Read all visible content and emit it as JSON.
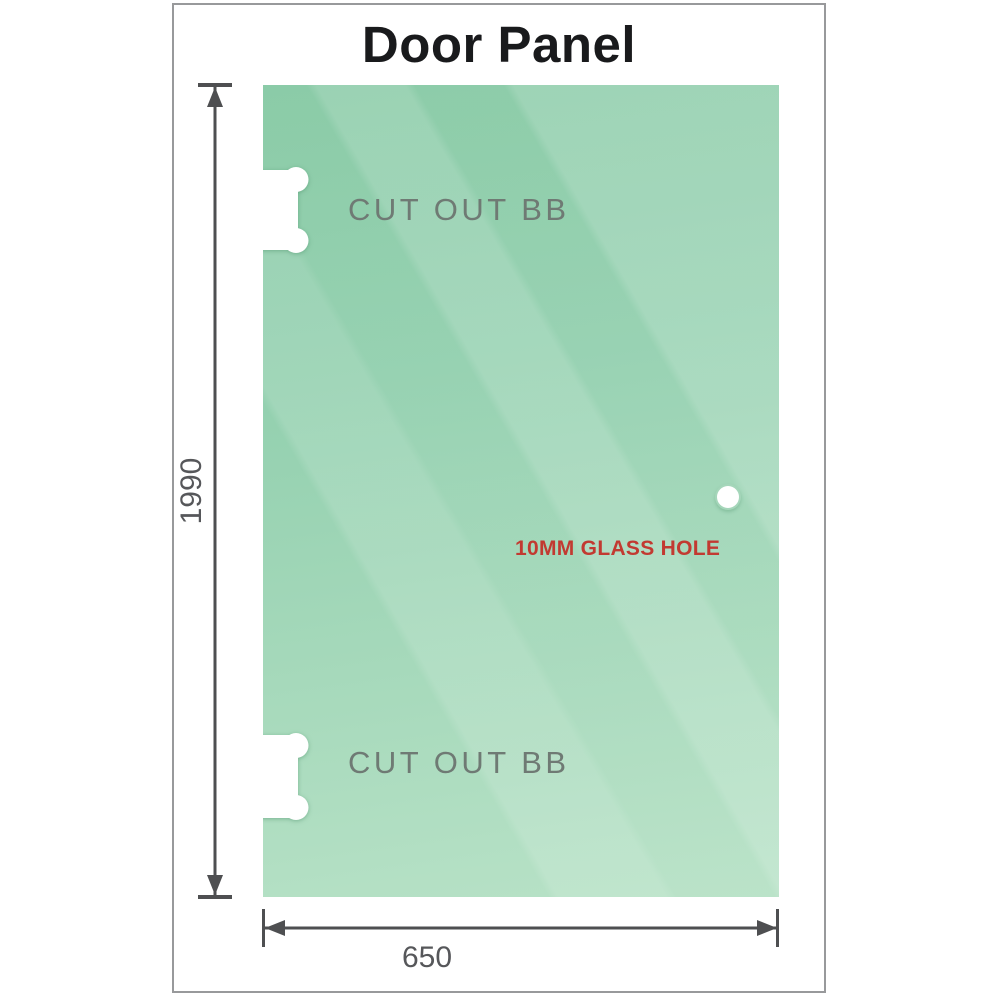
{
  "page": {
    "title": "Door Panel"
  },
  "panel": {
    "cutouts": [
      {
        "label": "CUT OUT BB",
        "position": "top-left"
      },
      {
        "label": "CUT OUT BB",
        "position": "bottom-left"
      }
    ],
    "hole": {
      "label": "10MM GLASS HOLE"
    }
  },
  "dimensions": {
    "height": {
      "value": "1990",
      "orientation": "vertical"
    },
    "width": {
      "value": "650",
      "orientation": "horizontal"
    }
  },
  "colors": {
    "frame_border": "#98999b",
    "title_text": "#191a1c",
    "glass_top": "#86c9a4",
    "glass_bottom": "#b8e2c7",
    "dim_line": "#4e4f51",
    "dim_text": "#56575a",
    "cutout_label": "#6f7a74",
    "hole_label": "#c23a31"
  }
}
